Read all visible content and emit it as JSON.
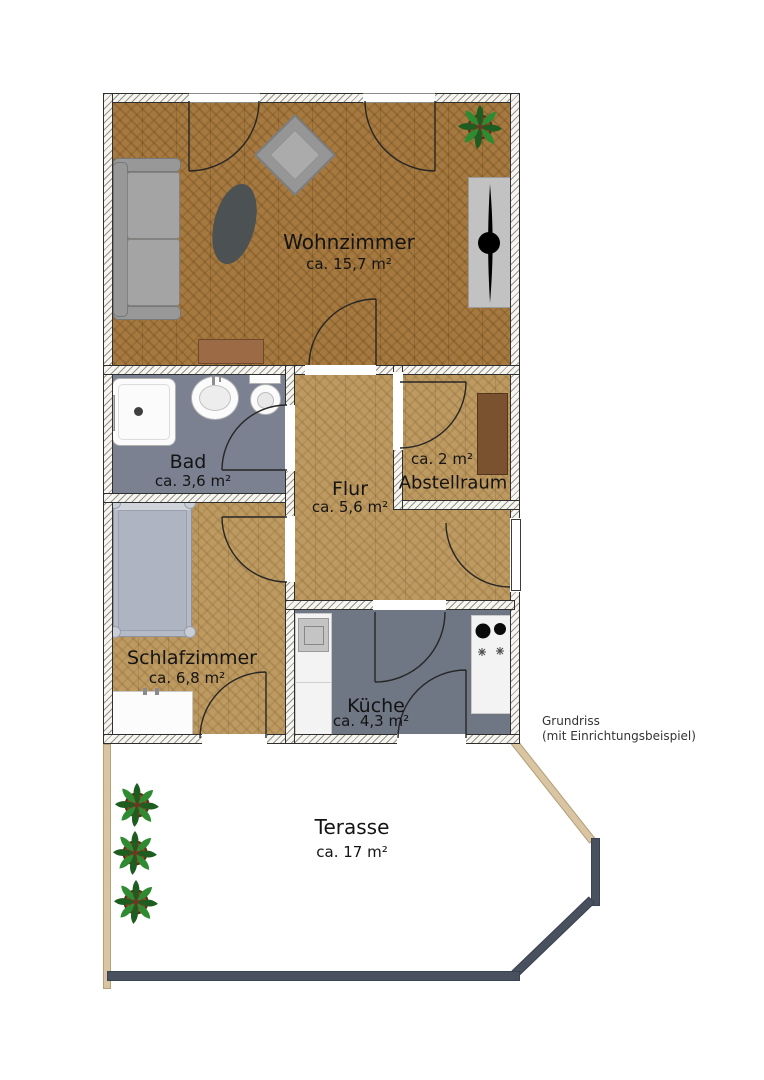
{
  "floorplan": {
    "note": {
      "line1": "Grundriss",
      "line2": "(mit Einrichtungsbeispiel)"
    },
    "rooms": [
      {
        "name": "Wohnzimmer",
        "area": "ca. 15,7 m²"
      },
      {
        "name": "Bad",
        "area": "ca. 3,6 m²"
      },
      {
        "name": "Flur",
        "area": "ca. 5,6 m²"
      },
      {
        "name": "Abstellraum",
        "area": "ca. 2 m²"
      },
      {
        "name": "Schlafzimmer",
        "area": "ca. 6,8 m²"
      },
      {
        "name": "Küche",
        "area": "ca. 4,3 m²"
      },
      {
        "name": "Terasse",
        "area": "ca. 17 m²"
      }
    ],
    "colors": {
      "wood_dark": "#a5793f",
      "wood_light": "#bd9a61",
      "bath_floor": "#7b8191",
      "kitchen_floor": "#6f7684",
      "terrace_wood": "#d9c5a2",
      "railing": "#49515f",
      "furniture_gray": "#9a9a9a",
      "shelf_brown": "#7a5230",
      "sideboard_brown": "#9c6b46",
      "text": "#141414"
    }
  }
}
